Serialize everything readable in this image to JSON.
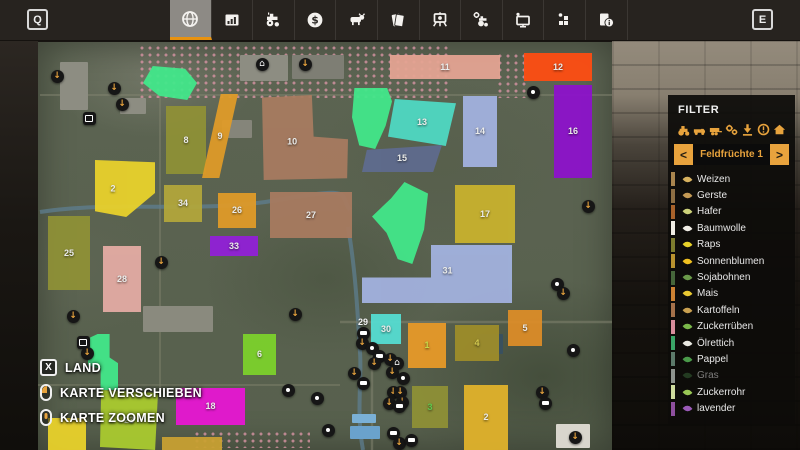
{
  "toolbar": {
    "left_key": "Q",
    "right_key": "E",
    "tabs": [
      {
        "icon": "map-globe-icon",
        "selected": true
      },
      {
        "icon": "statistics-chart-icon",
        "selected": false
      },
      {
        "icon": "vehicles-tractor-icon",
        "selected": false
      },
      {
        "icon": "finances-dollar-icon",
        "selected": false
      },
      {
        "icon": "animals-cow-icon",
        "selected": false
      },
      {
        "icon": "contracts-papers-icon",
        "selected": false
      },
      {
        "icon": "missions-easel-icon",
        "selected": false
      },
      {
        "icon": "shop-tractor-gear-icon",
        "selected": false
      },
      {
        "icon": "garage-screen-icon",
        "selected": false
      },
      {
        "icon": "production-blocks-icon",
        "selected": false
      },
      {
        "icon": "help-info-icon",
        "selected": false
      }
    ]
  },
  "filter": {
    "title": "FILTER",
    "icons": [
      "tractor",
      "truck",
      "trailer",
      "gears",
      "download",
      "alert",
      "house"
    ],
    "category": {
      "prev": "<",
      "label": "Feldfrüchte 1",
      "next": ">"
    },
    "crops": [
      {
        "label": "Weizen",
        "stripe": "#a9854e",
        "icon_color": "#d8b25f",
        "dimmed": false
      },
      {
        "label": "Gerste",
        "stripe": "#8d6e43",
        "icon_color": "#c49a55",
        "dimmed": false
      },
      {
        "label": "Hafer",
        "stripe": "#a8622a",
        "icon_color": "#cdd27a",
        "dimmed": false
      },
      {
        "label": "Baumwolle",
        "stripe": "#efece4",
        "icon_color": "#f0ede6",
        "dimmed": false
      },
      {
        "label": "Raps",
        "stripe": "#7d7c2e",
        "icon_color": "#e8d22a",
        "dimmed": false
      },
      {
        "label": "Sonnenblumen",
        "stripe": "#b8922e",
        "icon_color": "#f0c020",
        "dimmed": false
      },
      {
        "label": "Sojabohnen",
        "stripe": "#45663a",
        "icon_color": "#6a9a4a",
        "dimmed": false
      },
      {
        "label": "Mais",
        "stripe": "#cc8233",
        "icon_color": "#e8c832",
        "dimmed": false
      },
      {
        "label": "Kartoffeln",
        "stripe": "#a5714a",
        "icon_color": "#c9a050",
        "dimmed": false
      },
      {
        "label": "Zuckerrüben",
        "stripe": "#d78d9b",
        "icon_color": "#7ab84a",
        "dimmed": false
      },
      {
        "label": "Ölrettich",
        "stripe": "#3aa567",
        "icon_color": "#e8e8e0",
        "dimmed": false
      },
      {
        "label": "Pappel",
        "stripe": "#5c7a6a",
        "icon_color": "#4a9a4a",
        "dimmed": false
      },
      {
        "label": "Gras",
        "stripe": "#8e938e",
        "icon_color": "#3a6a3a",
        "dimmed": true
      },
      {
        "label": "Zuckerrohr",
        "stripe": "#cfdc9e",
        "icon_color": "#9ac855",
        "dimmed": false
      },
      {
        "label": "lavender",
        "stripe": "#8e4f9e",
        "icon_color": "#9a5ab8",
        "dimmed": false
      }
    ]
  },
  "legend": [
    {
      "type": "key",
      "key": "X",
      "label": "LAND"
    },
    {
      "type": "mouse-left",
      "key": "",
      "label": "KARTE VERSCHIEBEN"
    },
    {
      "type": "mouse-wheel",
      "key": "",
      "label": "KARTE ZOOMEN"
    }
  ],
  "icon_glyphs": {
    "download": "↓",
    "house": "⌂",
    "vehicle": "truck-shape",
    "misc": "dot",
    "box": "square"
  },
  "colors": {
    "accent_orange": "#e8920f",
    "icon_orange": "#e8a33d",
    "tab_selected_bg": "#8d8a85",
    "panel_bg": "rgba(13,12,10,0.93)"
  },
  "map": {
    "fields": [
      {
        "num": "",
        "x": 143,
        "y": 66,
        "w": 54,
        "h": 34,
        "color": "#42e88a",
        "clip": "polygon(18% 0, 78% 8%, 100% 50%, 82% 100%, 30% 88%, 0 50%)"
      },
      {
        "num": "8",
        "x": 166,
        "y": 106,
        "w": 40,
        "h": 68,
        "color": "#8f9136"
      },
      {
        "num": "9",
        "x": 202,
        "y": 94,
        "w": 36,
        "h": 84,
        "color": "#e09b28",
        "clip": "polygon(52% 0, 100% 0, 48% 100%, 0 100%)"
      },
      {
        "num": "2",
        "x": 95,
        "y": 160,
        "w": 60,
        "h": 57,
        "color": "#ead22b",
        "clip": "polygon(0 0, 100% 4%, 100% 58%, 52% 100%, 0 90%)",
        "lx": 30,
        "ly": 50
      },
      {
        "num": "34",
        "x": 164,
        "y": 185,
        "w": 38,
        "h": 37,
        "color": "#b3a73b"
      },
      {
        "num": "26",
        "x": 218,
        "y": 193,
        "w": 38,
        "h": 35,
        "color": "#e09b28"
      },
      {
        "num": "10",
        "x": 262,
        "y": 95,
        "w": 86,
        "h": 85,
        "color": "#a87b60",
        "clip": "polygon(0 3%, 58% 0, 60% 49%, 100% 52%, 99% 98%, 2% 100%)",
        "lx": 35,
        "ly": 55
      },
      {
        "num": "27",
        "x": 270,
        "y": 192,
        "w": 82,
        "h": 46,
        "color": "#a87b60"
      },
      {
        "num": "33",
        "x": 210,
        "y": 236,
        "w": 48,
        "h": 20,
        "color": "#9220d8"
      },
      {
        "num": "25",
        "x": 48,
        "y": 216,
        "w": 42,
        "h": 74,
        "color": "#8f9136"
      },
      {
        "num": "28",
        "x": 103,
        "y": 246,
        "w": 38,
        "h": 66,
        "color": "#e5aca4"
      },
      {
        "num": "",
        "x": 352,
        "y": 88,
        "w": 40,
        "h": 61,
        "color": "#42e88a",
        "clip": "polygon(6% 0, 88% 0, 100% 22%, 84% 62%, 58% 100%, 18% 94%, 0 48%)"
      },
      {
        "num": "13",
        "x": 388,
        "y": 99,
        "w": 68,
        "h": 47,
        "color": "#4fd9c4",
        "clip": "polygon(10% 0, 100% 9%, 85% 100%, 0 80%)"
      },
      {
        "num": "15",
        "x": 362,
        "y": 145,
        "w": 80,
        "h": 27,
        "color": "#5f6b8f",
        "clip": "polygon(6% 18%, 100% 0, 89% 100%, 0 100%)"
      },
      {
        "num": "14",
        "x": 463,
        "y": 96,
        "w": 34,
        "h": 71,
        "color": "#a3b2e0"
      },
      {
        "num": "11",
        "x": 390,
        "y": 55,
        "w": 110,
        "h": 24,
        "color": "#e5a493"
      },
      {
        "num": "12",
        "x": 524,
        "y": 53,
        "w": 68,
        "h": 28,
        "color": "#ff4d12"
      },
      {
        "num": "16",
        "x": 554,
        "y": 85,
        "w": 38,
        "h": 93,
        "color": "#8d12cc"
      },
      {
        "num": "17",
        "x": 455,
        "y": 185,
        "w": 60,
        "h": 58,
        "color": "#c9b22e"
      },
      {
        "num": "",
        "x": 372,
        "y": 182,
        "w": 56,
        "h": 82,
        "color": "#42e88a",
        "clip": "polygon(58% 0, 100% 14%, 93% 58%, 72% 100%, 46% 94%, 26% 62%, 0 42%, 34% 20%)"
      },
      {
        "num": "31",
        "x": 362,
        "y": 245,
        "w": 150,
        "h": 58,
        "color": "#a3b2e0",
        "clip": "polygon(46% 0, 100% 0, 100% 100%, 0 100%, 0 56%, 46% 56%)",
        "lx": 57,
        "ly": 44
      },
      {
        "num": "30",
        "x": 371,
        "y": 314,
        "w": 30,
        "h": 30,
        "color": "#55ded2"
      },
      {
        "num": "1",
        "x": 408,
        "y": 323,
        "w": 38,
        "h": 45,
        "color": "#e89a28",
        "label_color": "#cde049"
      },
      {
        "num": "4",
        "x": 455,
        "y": 325,
        "w": 44,
        "h": 36,
        "color": "#9e8d2a",
        "label_color": "#ded24f"
      },
      {
        "num": "5",
        "x": 508,
        "y": 310,
        "w": 34,
        "h": 36,
        "color": "#dd8d28"
      },
      {
        "num": "3",
        "x": 412,
        "y": 386,
        "w": 36,
        "h": 42,
        "color": "#8f9136",
        "label_color": "#5fcf4f"
      },
      {
        "num": "2",
        "x": 464,
        "y": 385,
        "w": 44,
        "h": 65,
        "color": "#e2b32b"
      },
      {
        "num": "6",
        "x": 243,
        "y": 334,
        "w": 33,
        "h": 41,
        "color": "#7dd22c"
      },
      {
        "num": "18",
        "x": 176,
        "y": 388,
        "w": 69,
        "h": 37,
        "color": "#e816d3"
      },
      {
        "num": "23",
        "x": 100,
        "y": 390,
        "w": 58,
        "h": 60,
        "color": "#aacb2f",
        "clip": "polygon(2% 0, 100% 5%, 95% 100%, 0 95%)",
        "label_color": "#cfdcb8"
      },
      {
        "num": "",
        "x": 48,
        "y": 418,
        "w": 38,
        "h": 32,
        "color": "#ead22b"
      },
      {
        "num": "",
        "x": 162,
        "y": 437,
        "w": 60,
        "h": 13,
        "color": "#c9a032"
      },
      {
        "num": "",
        "x": 88,
        "y": 334,
        "w": 30,
        "h": 56,
        "color": "#42e88a",
        "clip": "polygon(32% 0, 72% 0, 72% 42%, 100% 52%, 100% 100%, 42% 100%, 42% 62%, 0 56%, 0 8%)"
      }
    ],
    "labels": [
      {
        "text": "29",
        "x": 363,
        "y": 322
      }
    ],
    "structures": [
      {
        "x": 240,
        "y": 55,
        "w": 48,
        "h": 26,
        "color": "#8d8d82"
      },
      {
        "x": 292,
        "y": 55,
        "w": 52,
        "h": 24,
        "color": "#7e7e74"
      },
      {
        "x": 60,
        "y": 62,
        "w": 28,
        "h": 48,
        "color": "#8d8d82"
      },
      {
        "x": 120,
        "y": 98,
        "w": 26,
        "h": 16,
        "color": "#8d8d82"
      },
      {
        "x": 222,
        "y": 120,
        "w": 30,
        "h": 18,
        "color": "#85857a"
      },
      {
        "x": 143,
        "y": 306,
        "w": 70,
        "h": 26,
        "color": "#8a8a7e"
      },
      {
        "x": 352,
        "y": 414,
        "w": 24,
        "h": 9,
        "color": "#7ab0d6"
      },
      {
        "x": 350,
        "y": 426,
        "w": 30,
        "h": 13,
        "color": "#6aa2cc"
      },
      {
        "x": 477,
        "y": 334,
        "w": 26,
        "h": 20,
        "color": "#39505e"
      },
      {
        "x": 556,
        "y": 424,
        "w": 34,
        "h": 24,
        "color": "#d9d6cd"
      }
    ],
    "icons": [
      {
        "type": "download",
        "x": 57,
        "y": 76
      },
      {
        "type": "download",
        "x": 114,
        "y": 88
      },
      {
        "type": "download",
        "x": 122,
        "y": 104
      },
      {
        "type": "box",
        "x": 89,
        "y": 118
      },
      {
        "type": "house",
        "x": 262,
        "y": 64
      },
      {
        "type": "download",
        "x": 305,
        "y": 64
      },
      {
        "type": "misc",
        "x": 533,
        "y": 92
      },
      {
        "type": "download",
        "x": 588,
        "y": 206
      },
      {
        "type": "misc",
        "x": 557,
        "y": 284
      },
      {
        "type": "download",
        "x": 563,
        "y": 293
      },
      {
        "type": "download",
        "x": 161,
        "y": 262
      },
      {
        "type": "download",
        "x": 73,
        "y": 316
      },
      {
        "type": "download",
        "x": 295,
        "y": 314
      },
      {
        "type": "box",
        "x": 83,
        "y": 342
      },
      {
        "type": "download",
        "x": 87,
        "y": 353
      },
      {
        "type": "vehicle",
        "x": 363,
        "y": 333
      },
      {
        "type": "download",
        "x": 362,
        "y": 343
      },
      {
        "type": "misc",
        "x": 372,
        "y": 348
      },
      {
        "type": "vehicle",
        "x": 379,
        "y": 356
      },
      {
        "type": "download",
        "x": 374,
        "y": 363
      },
      {
        "type": "download",
        "x": 390,
        "y": 359
      },
      {
        "type": "house",
        "x": 397,
        "y": 363
      },
      {
        "type": "download",
        "x": 392,
        "y": 372
      },
      {
        "type": "download",
        "x": 354,
        "y": 373
      },
      {
        "type": "vehicle",
        "x": 363,
        "y": 383
      },
      {
        "type": "misc",
        "x": 403,
        "y": 378
      },
      {
        "type": "download",
        "x": 393,
        "y": 392
      },
      {
        "type": "download",
        "x": 400,
        "y": 392
      },
      {
        "type": "download",
        "x": 402,
        "y": 402
      },
      {
        "type": "download",
        "x": 389,
        "y": 403
      },
      {
        "type": "vehicle",
        "x": 399,
        "y": 406
      },
      {
        "type": "misc",
        "x": 288,
        "y": 390
      },
      {
        "type": "misc",
        "x": 317,
        "y": 398
      },
      {
        "type": "misc",
        "x": 328,
        "y": 430
      },
      {
        "type": "vehicle",
        "x": 393,
        "y": 433
      },
      {
        "type": "download",
        "x": 399,
        "y": 443
      },
      {
        "type": "vehicle",
        "x": 411,
        "y": 440
      },
      {
        "type": "misc",
        "x": 573,
        "y": 350
      },
      {
        "type": "download",
        "x": 542,
        "y": 392
      },
      {
        "type": "vehicle",
        "x": 545,
        "y": 403
      },
      {
        "type": "download",
        "x": 575,
        "y": 437
      }
    ]
  }
}
